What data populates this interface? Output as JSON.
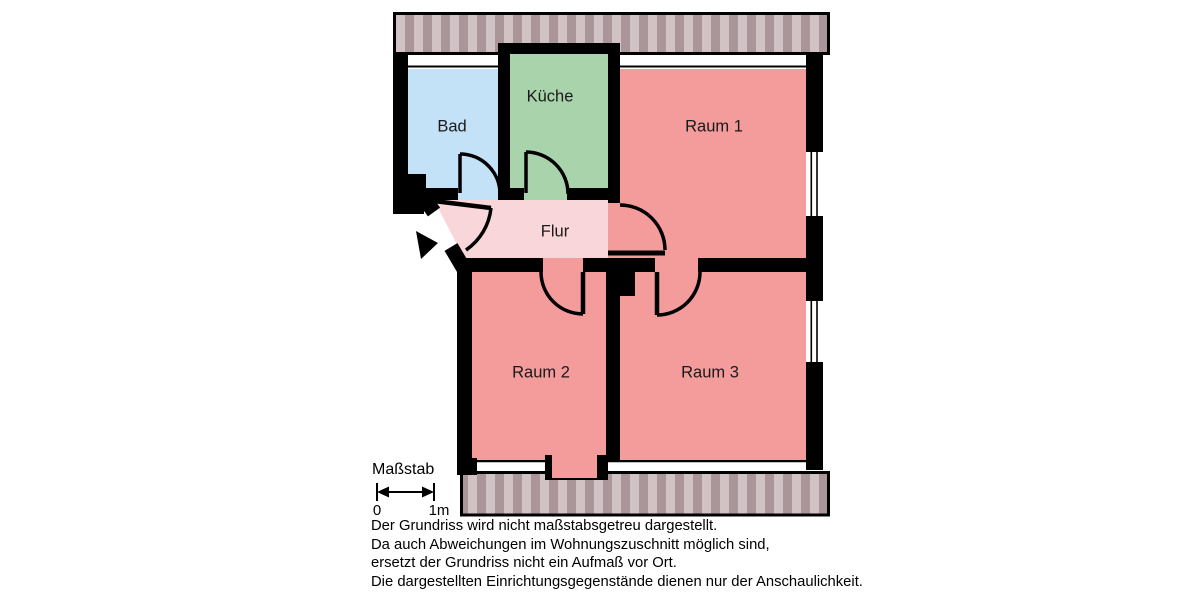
{
  "floorplan": {
    "rooms": [
      {
        "id": "bad",
        "label": "Bad",
        "color": "#c3e2f7"
      },
      {
        "id": "kueche",
        "label": "Küche",
        "color": "#a9d3ab"
      },
      {
        "id": "raum1",
        "label": "Raum 1",
        "color": "#f49b9b"
      },
      {
        "id": "flur",
        "label": "Flur",
        "color": "#f8d6da"
      },
      {
        "id": "raum2",
        "label": "Raum 2",
        "color": "#f49b9b"
      },
      {
        "id": "raum3",
        "label": "Raum 3",
        "color": "#f49b9b"
      }
    ],
    "colors": {
      "walls": "#000000",
      "hatch_light": "#d1c3c5",
      "hatch_dark": "#aa9598",
      "background": "#ffffff"
    }
  },
  "scale": {
    "title": "Maßstab",
    "start_label": "0",
    "end_label": "1m"
  },
  "disclaimer": {
    "lines": [
      "Der Grundriss wird nicht maßstabsgetreu dargestellt.",
      "Da auch Abweichungen im Wohnungszuschnitt möglich sind,",
      "ersetzt der Grundriss nicht ein Aufmaß vor Ort.",
      "Die dargestellten Einrichtungsgegenstände dienen nur der Anschaulichkeit."
    ]
  }
}
